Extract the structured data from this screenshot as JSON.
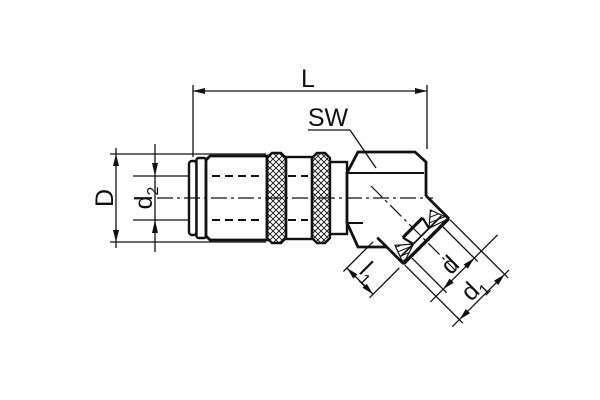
{
  "drawing": {
    "background": "#ffffff",
    "line_color": "#111111",
    "labels": {
      "L": "L",
      "SW": "SW",
      "D": "D",
      "d2_base": "d",
      "d2_sub": "2",
      "l1_base": "l",
      "l1_sub": "1",
      "d": "d",
      "d1_base": "d",
      "d1_sub": "1"
    }
  }
}
